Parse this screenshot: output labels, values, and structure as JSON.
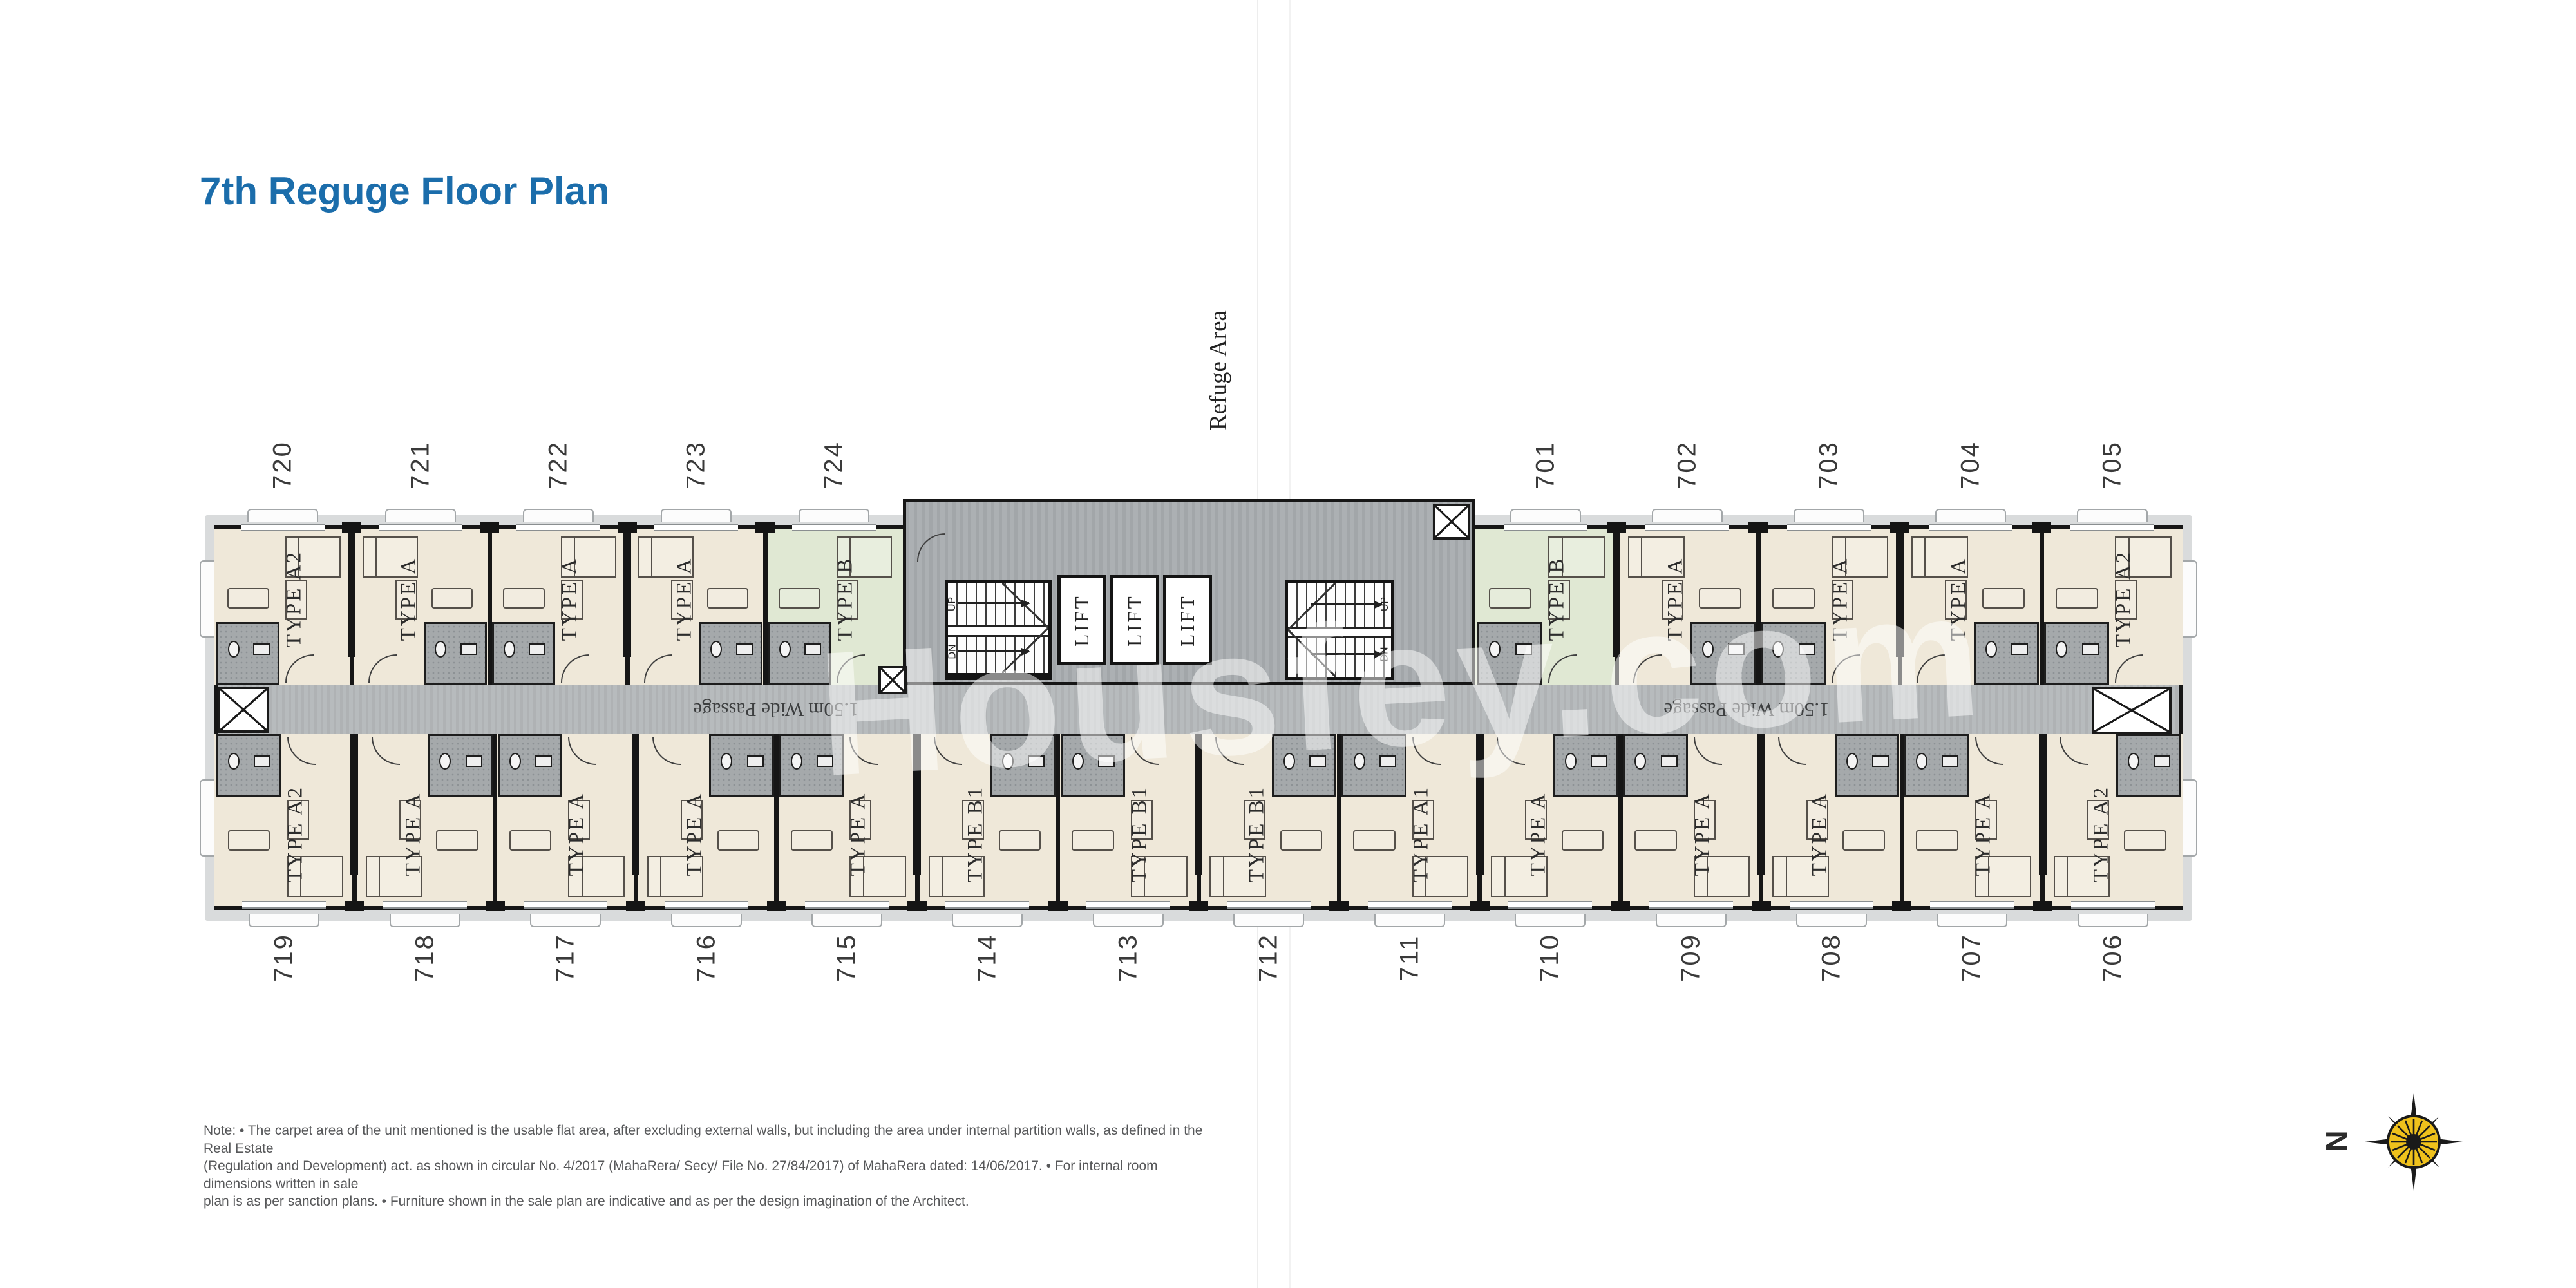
{
  "title": "7th Reguge Floor Plan",
  "watermark": "Housfey.com",
  "plan": {
    "refuge_area_label": "Refuge Area",
    "passage_label": "1.50m Wide Passage",
    "lift_label": "LIFT",
    "stairs": {
      "up": "UP",
      "dn": "DN"
    },
    "units": {
      "top_left": [
        {
          "number": "720",
          "type": "TYPE A2",
          "tint": "cream"
        },
        {
          "number": "721",
          "type": "TYPE A",
          "tint": "cream"
        },
        {
          "number": "722",
          "type": "TYPE A",
          "tint": "cream"
        },
        {
          "number": "723",
          "type": "TYPE A",
          "tint": "cream"
        },
        {
          "number": "724",
          "type": "TYPE B",
          "tint": "green"
        }
      ],
      "top_right": [
        {
          "number": "701",
          "type": "TYPE B",
          "tint": "green"
        },
        {
          "number": "702",
          "type": "TYPE A",
          "tint": "cream"
        },
        {
          "number": "703",
          "type": "TYPE A",
          "tint": "cream"
        },
        {
          "number": "704",
          "type": "TYPE A",
          "tint": "cream"
        },
        {
          "number": "705",
          "type": "TYPE A2",
          "tint": "cream"
        }
      ],
      "bottom": [
        {
          "number": "719",
          "type": "TYPE A2",
          "tint": "cream"
        },
        {
          "number": "718",
          "type": "TYPE A",
          "tint": "cream"
        },
        {
          "number": "717",
          "type": "TYPE A",
          "tint": "cream"
        },
        {
          "number": "716",
          "type": "TYPE A",
          "tint": "cream"
        },
        {
          "number": "715",
          "type": "TYPE A",
          "tint": "cream"
        },
        {
          "number": "714",
          "type": "TYPE B1",
          "tint": "cream"
        },
        {
          "number": "713",
          "type": "TYPE B1",
          "tint": "cream"
        },
        {
          "number": "712",
          "type": "TYPE B1",
          "tint": "cream"
        },
        {
          "number": "711",
          "type": "TYPE A1",
          "tint": "cream"
        },
        {
          "number": "710",
          "type": "TYPE A",
          "tint": "cream"
        },
        {
          "number": "709",
          "type": "TYPE A",
          "tint": "cream"
        },
        {
          "number": "708",
          "type": "TYPE A",
          "tint": "cream"
        },
        {
          "number": "707",
          "type": "TYPE A",
          "tint": "cream"
        },
        {
          "number": "706",
          "type": "TYPE A2",
          "tint": "cream"
        }
      ]
    }
  },
  "note_lines": [
    "Note: • The carpet area of the unit mentioned is the usable flat area, after excluding external walls, but including the area under internal partition walls, as defined in the Real Estate",
    "(Regulation and Development) act. as shown in circular No. 4/2017 (MahaRera/ Secy/ File No. 27/84/2017) of MahaRera dated: 14/06/2017. • For internal room dimensions written in sale",
    "plan is as per sanction plans. • Furniture shown in the sale plan are indicative and as per the design imagination of the Architect."
  ],
  "compass": {
    "label": "N"
  },
  "colors": {
    "title_blue": "#1b6dab",
    "unit_cream": "#efe8d9",
    "unit_green": "#e0e8d3",
    "corridor_gray": "#b5b9bb",
    "core_gray": "#a9adb0",
    "bath_gray": "#a5a9ab",
    "wall_black": "#161616",
    "compass_yellow": "#efc11c"
  }
}
